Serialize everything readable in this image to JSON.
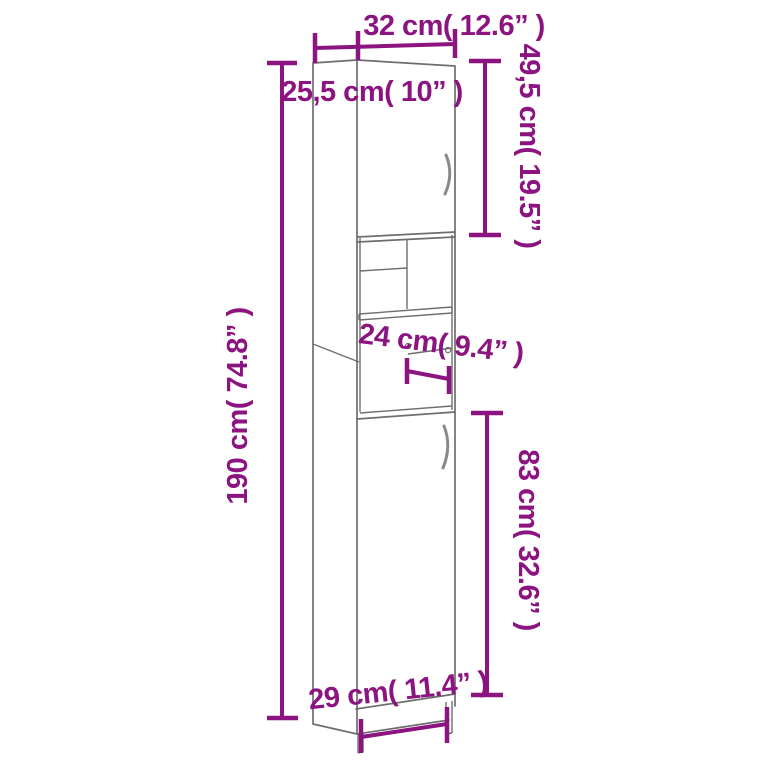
{
  "page": {
    "description": "Dimension diagram of a tall narrow bathroom storage cabinet with two doors and open middle shelves"
  },
  "colors": {
    "dimension_accent": "#8C1480",
    "cabinet_outline": "#6e6e6e",
    "handle_gray": "#8a8a8a",
    "background": "#ffffff"
  },
  "labels": {
    "width_top": "32 cm( 12.6” )",
    "depth_top": "25,5 cm( 10” )",
    "door_top_height": "49,5 cm( 19.5” )",
    "total_height": "190 cm( 74.8” )",
    "shelf_depth": "24 cm( 9.4” )",
    "door_bottom_height": "83 cm( 32.6” )",
    "base_width": "29 cm( 11.4” )"
  }
}
